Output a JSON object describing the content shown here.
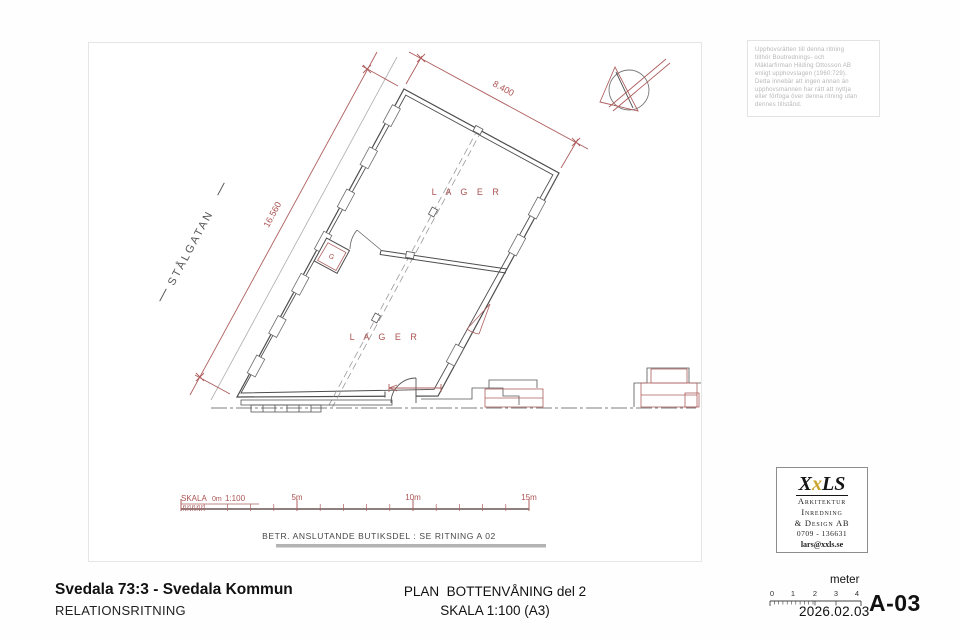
{
  "sheet": {
    "plan": {
      "dim_top": "8.400",
      "dim_left": "16.560",
      "street": "STÅLGATAN",
      "lager_upper": "L A G E R",
      "lager_lower": "L A G E R",
      "closet": "G"
    },
    "scalebar": {
      "skala": "SKALA",
      "zero": "0m",
      "ratio": "1:100",
      "m5": "5m",
      "m10": "10m",
      "m15": "15m"
    },
    "note": "BETR. ANSLUTANDE BUTIKSDEL : SE RITNING A 02"
  },
  "copyright": {
    "lines": [
      "Upphovsrätten till denna ritning",
      "tillhör Boutrednings- och",
      "Mäklarfirman Hilding Ottosson AB",
      "enligt upphovslagen (1960:729).",
      "Detta innebär att ingen annan än",
      "upphovsmannen har rätt att nyttja",
      "eller förfoga över denna ritning utan",
      "dennes tillstånd."
    ]
  },
  "logo": {
    "wordmark": {
      "x1": "X",
      "x2": "x",
      "rest": "LS"
    },
    "lines": [
      "Arkitektur",
      "Inredning",
      "& Design AB"
    ],
    "phone": "0709 - 136631",
    "email": "lars@xxls.se"
  },
  "titleblock": {
    "project": "Svedala 73:3 - Svedala Kommun",
    "doctype": "RELATIONSRITNING",
    "title": "PLAN  BOTTENVÅNING del 2",
    "scale": "SKALA 1:100 (A3)",
    "ruler": {
      "unit": "meter",
      "ticks": [
        "0",
        "1",
        "2",
        "3",
        "4"
      ]
    },
    "date": "2026.02.03",
    "sheet_no": "A-03"
  },
  "colors": {
    "red": "#ae5f5f",
    "wall": "#4d4d4d",
    "gray": "#999999"
  }
}
